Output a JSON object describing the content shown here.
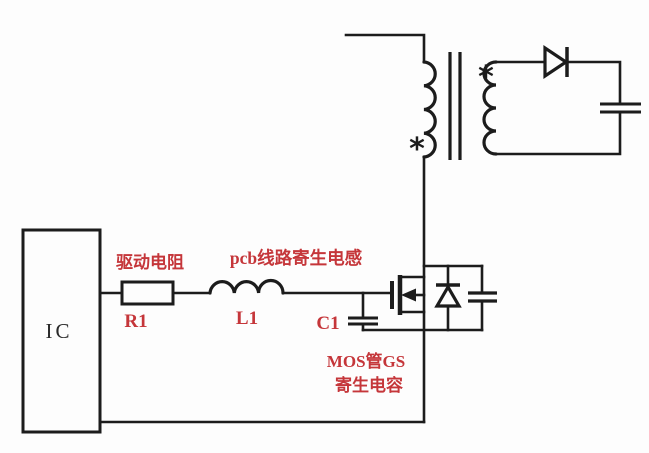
{
  "colors": {
    "wire": "#1c1c1c",
    "label_red": "#c5363a",
    "text_black": "#2a2a2a",
    "background": "#fdfdfd"
  },
  "components": {
    "ic": {
      "label": "IC"
    },
    "drive_resistor": {
      "annotation": "驱动电阻",
      "designator": "R1"
    },
    "pcb_trace_inductor": {
      "annotation": "pcb线路寄生电感",
      "designator": "L1"
    },
    "gs_parasitic_capacitor": {
      "designator": "C1",
      "annotation_line1": "MOS管GS",
      "annotation_line2": "寄生电容"
    },
    "transformer": {
      "primary_dot": "*",
      "secondary_dot": "*"
    }
  }
}
